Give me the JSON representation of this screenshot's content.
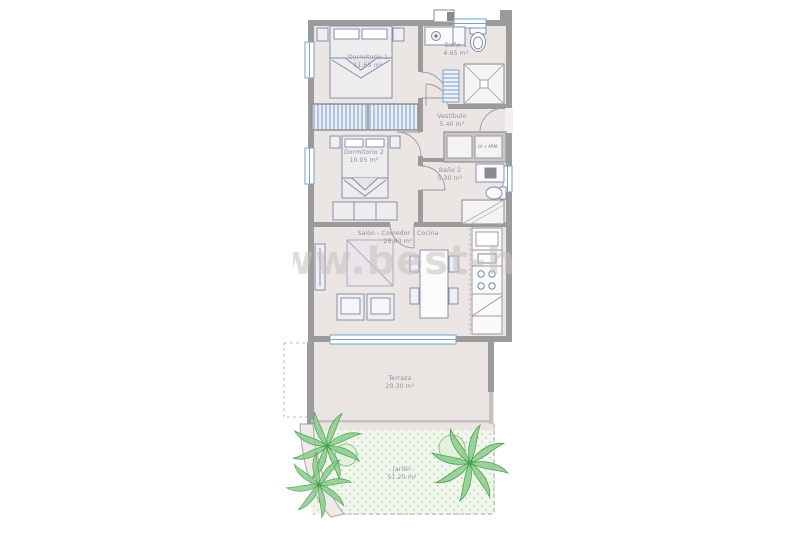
{
  "watermark": {
    "text": "www.best-home"
  },
  "closet": {
    "label": "LV + ARM."
  },
  "rooms": [
    {
      "id": "dormitorio-1",
      "name": "Dormitorio 1",
      "area": "11.65 m²"
    },
    {
      "id": "bano-1",
      "name": "Baño 1",
      "area": "4.65 m²"
    },
    {
      "id": "vestibulo",
      "name": "Vestíbulo",
      "area": "5.40 m²"
    },
    {
      "id": "dormitorio-2",
      "name": "Dormitorio 2",
      "area": "10.05 m²"
    },
    {
      "id": "bano-2",
      "name": "Baño 2",
      "area": "5.30 m²"
    },
    {
      "id": "salon",
      "name": "Salón - Comedor - Cocina",
      "area": "26.80 m²"
    },
    {
      "id": "terraza",
      "name": "Terraza",
      "area": "20.30 m²"
    },
    {
      "id": "jardin",
      "name": "Jardín",
      "area": "51.20 m²"
    }
  ],
  "colors": {
    "wall": "#9b9b9b",
    "floor": "#ebe5e4",
    "furn": "#7a87a6",
    "win": "#7aa0c8",
    "green": "#4aa355",
    "greenfill": "#8ccb8c",
    "label": "#8b90a2",
    "wm": "#c9c1c1"
  }
}
